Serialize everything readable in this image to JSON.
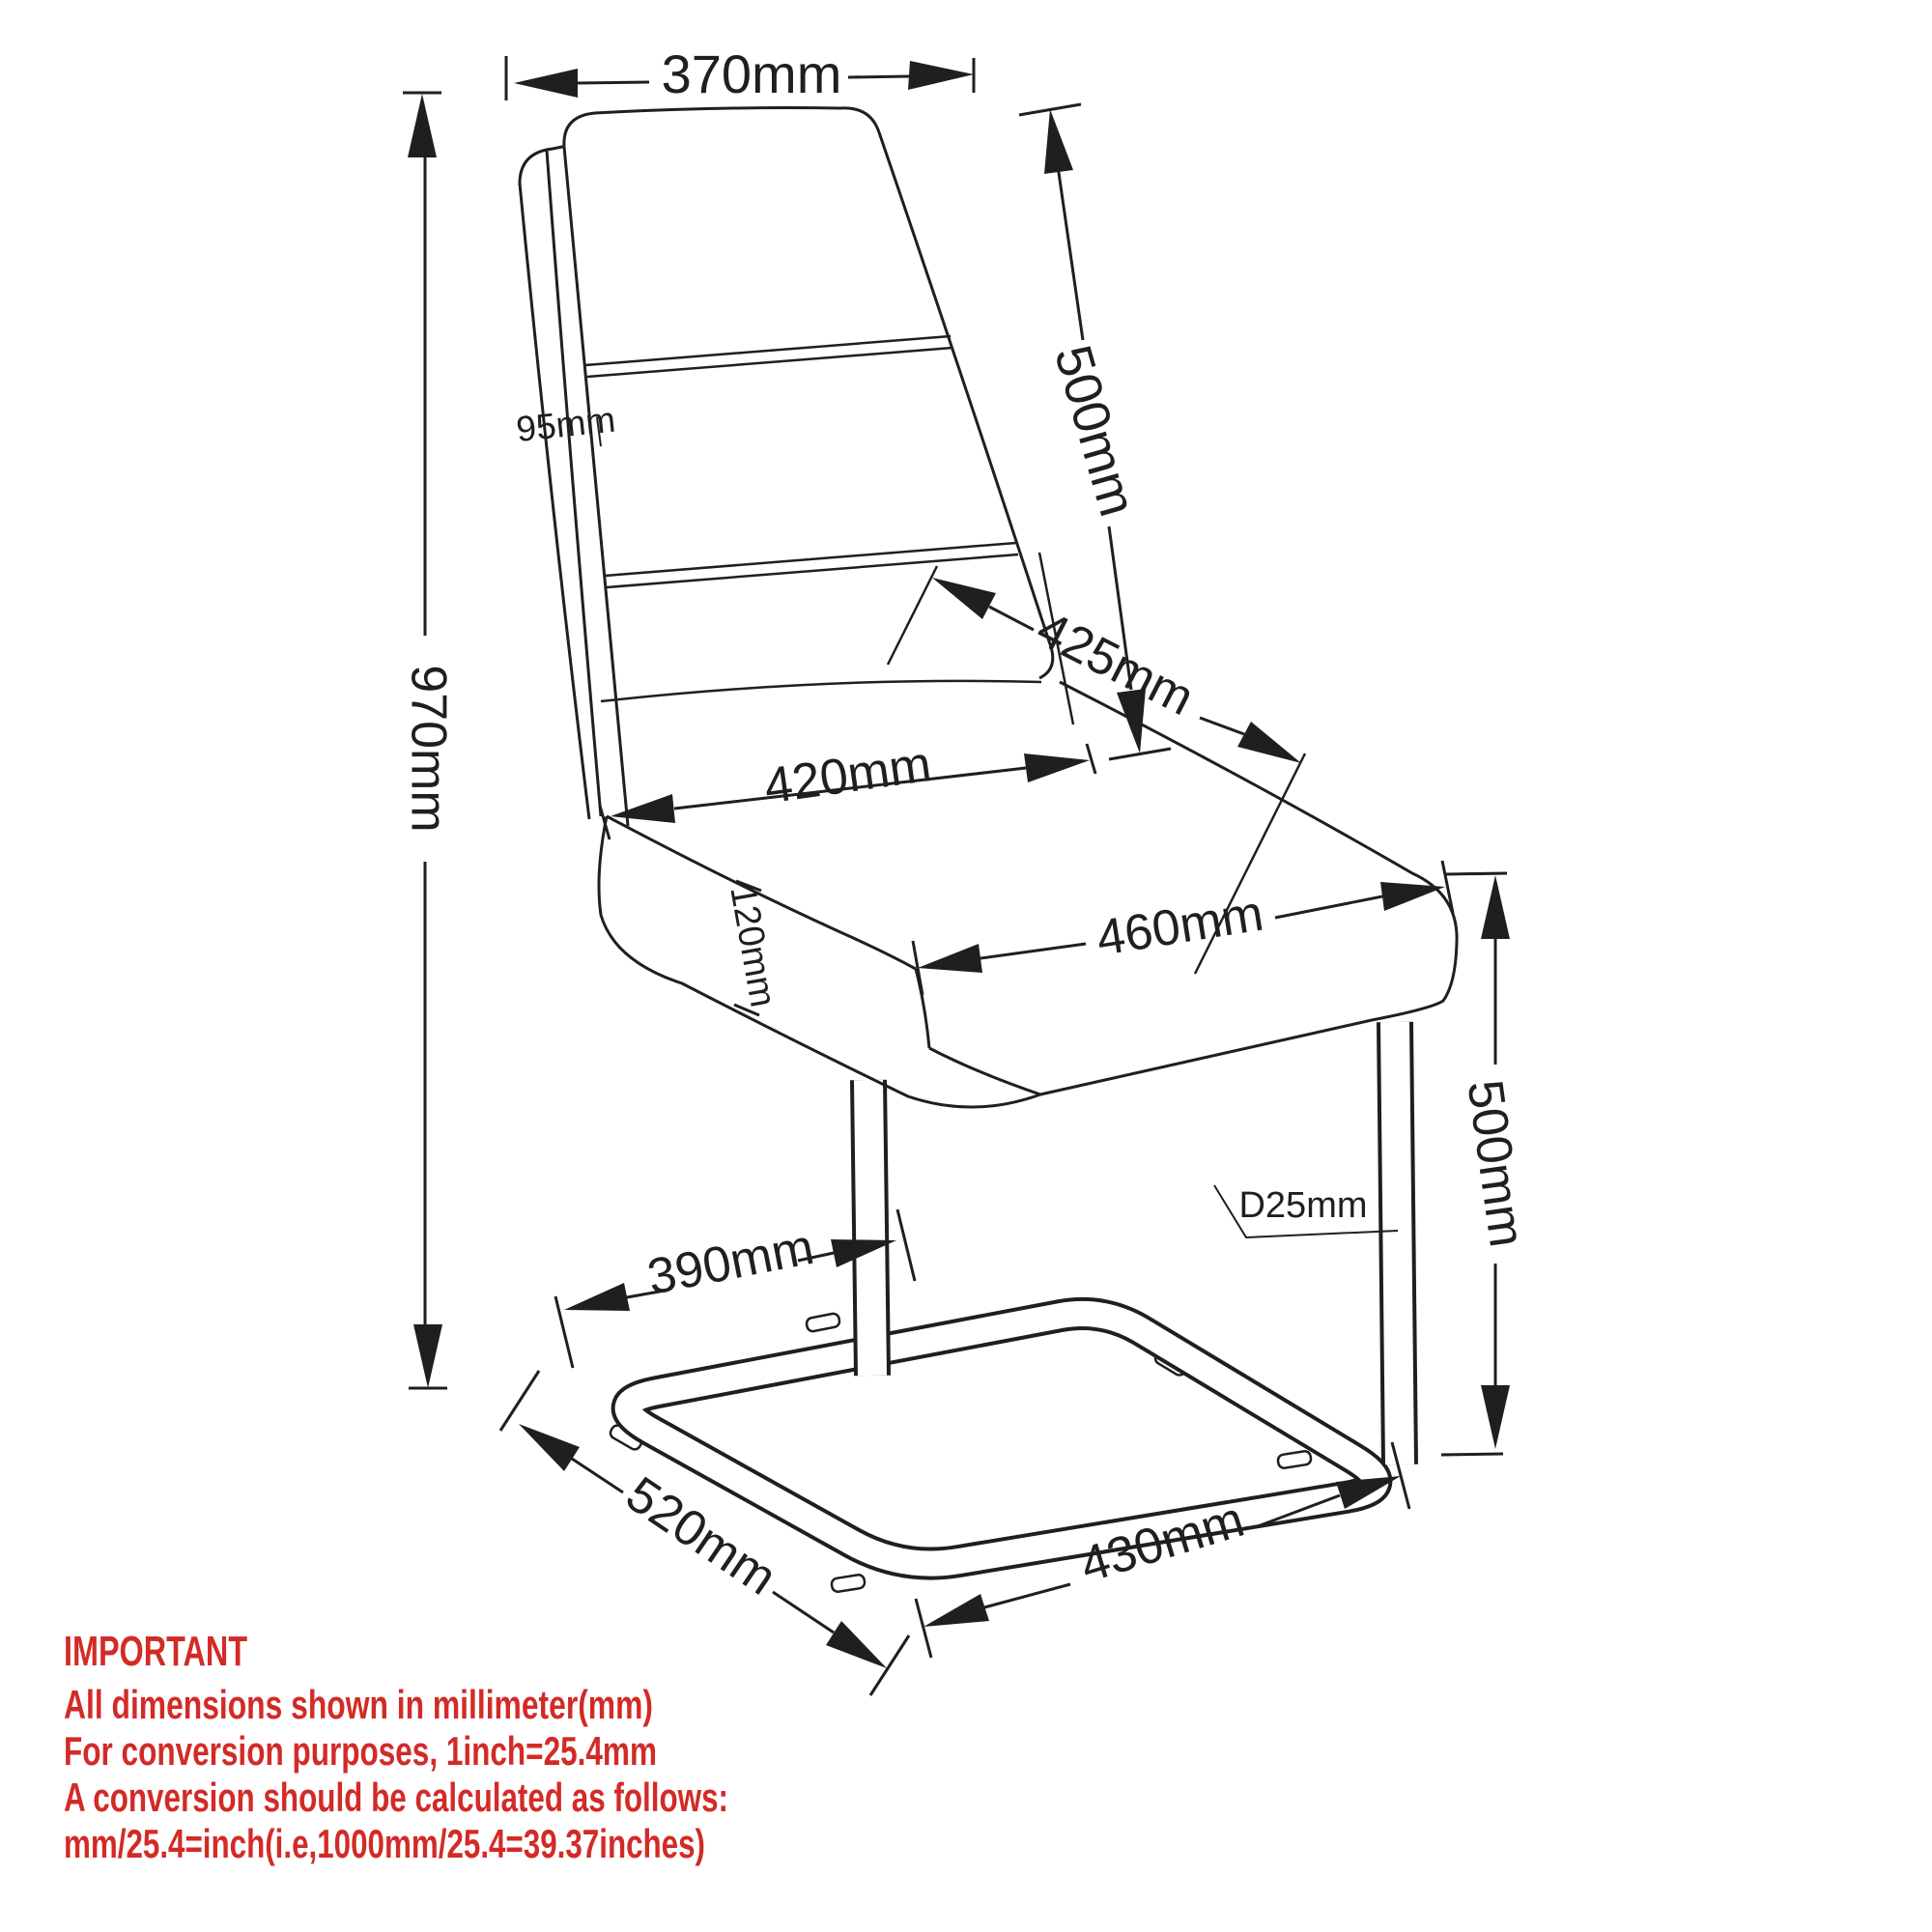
{
  "diagram": {
    "kind": "cantilever chair technical dimension drawing",
    "units": "mm",
    "colors": {
      "ink": "#1f1f1f",
      "note_red": "#d22b27",
      "background": "#ffffff"
    }
  },
  "dims": {
    "backrest_width": "370mm",
    "backrest_height": "500mm",
    "backrest_thickness": "95mm",
    "backrest_diagonal": "425mm",
    "seat_width": "420mm",
    "seat_depth": "460mm",
    "seat_thickness": "120mm",
    "overall_height": "970mm",
    "seat_height": "500mm",
    "tube_diameter": "D25mm",
    "front_leg_offset": "390mm",
    "base_depth": "520mm",
    "base_width": "430mm"
  },
  "notes": {
    "heading": "IMPORTANT",
    "lines": [
      "All dimensions shown in millimeter(mm)",
      "For conversion purposes, 1inch=25.4mm",
      "A conversion should be calculated as follows:",
      "mm/25.4=inch(i.e,1000mm/25.4=39.37inches)"
    ]
  }
}
